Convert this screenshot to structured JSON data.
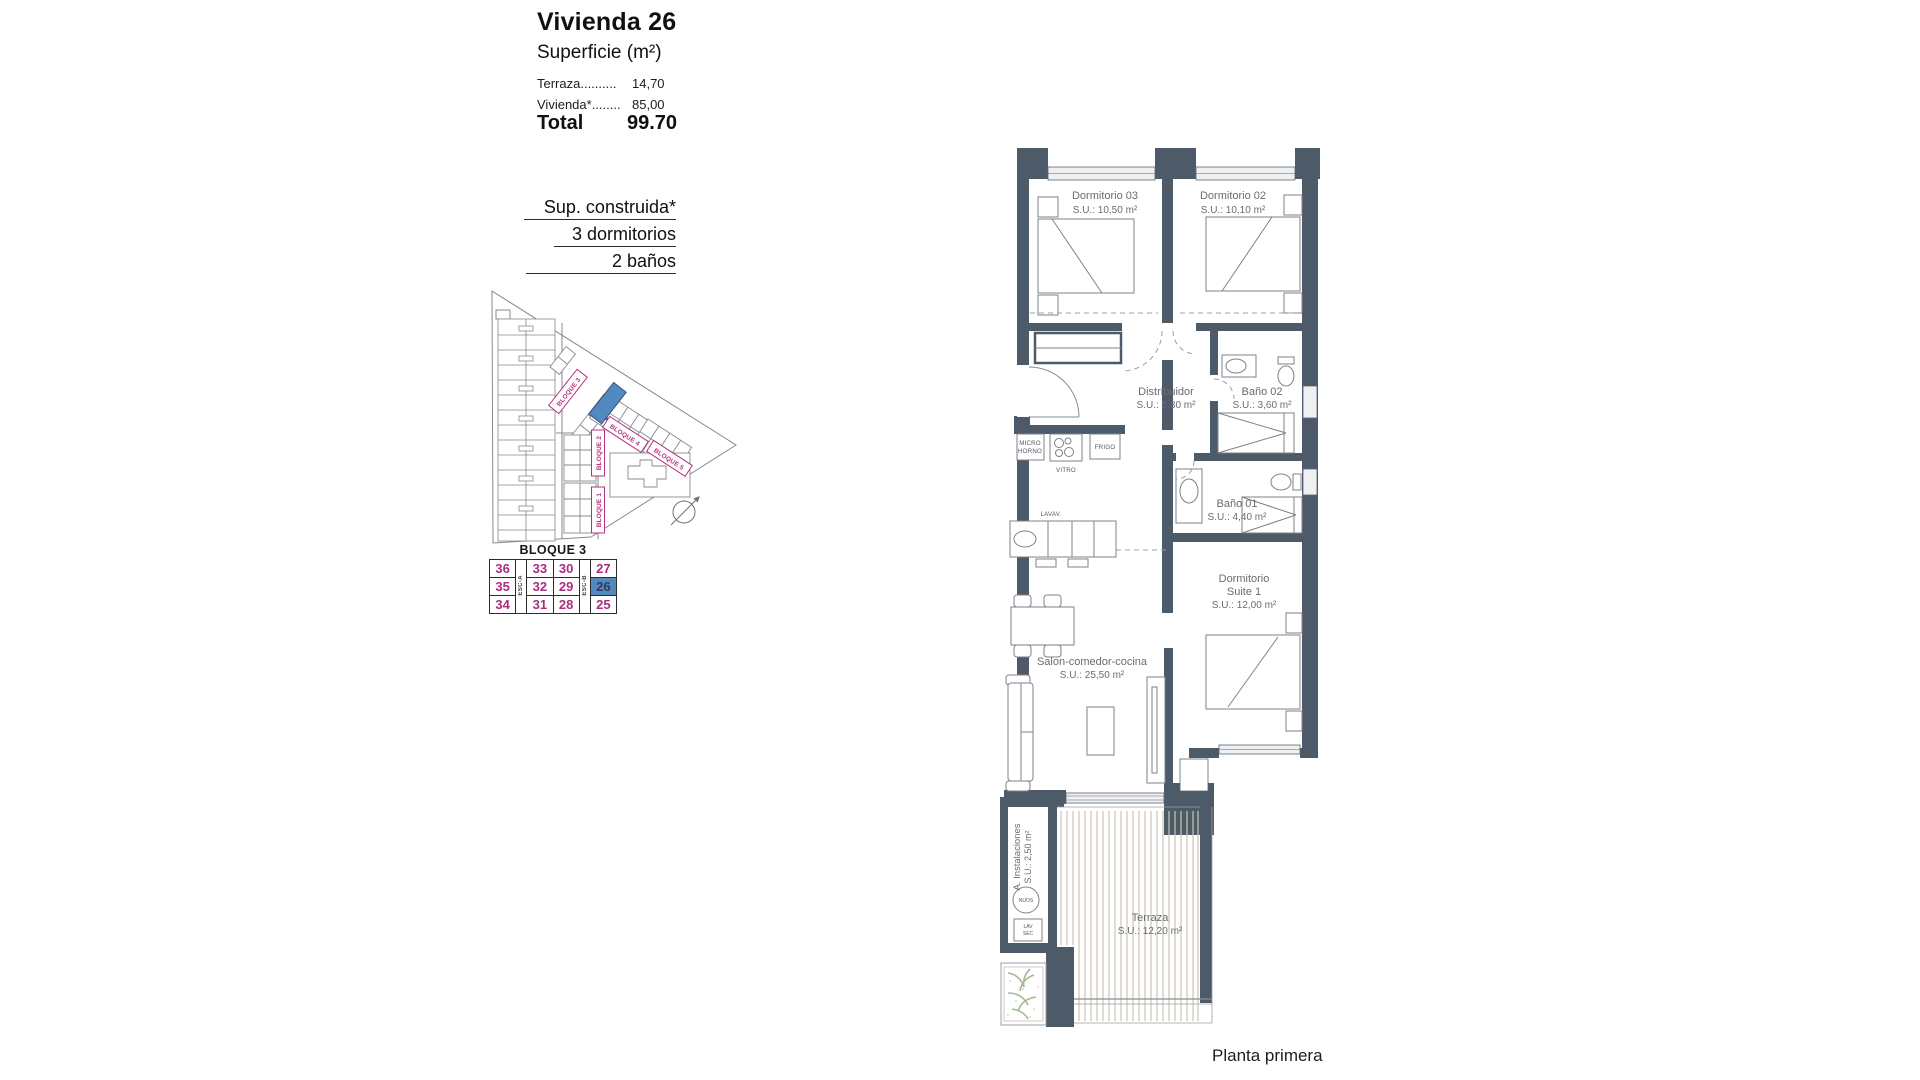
{
  "header": {
    "title": "Vivienda 26",
    "subtitle": "Superficie (m²)",
    "rows": [
      {
        "label": "Terraza..........",
        "value": "14,70"
      },
      {
        "label": "Vivienda*........",
        "value": "85,00"
      }
    ],
    "total_label": "Total",
    "total_value": "99.70"
  },
  "built_info": {
    "title": "Sup. construida*",
    "bedrooms": "3 dormitorios",
    "bathrooms": "2 baños"
  },
  "site_plan": {
    "block_labels": {
      "b1": "BLOQUE 1",
      "b2": "BLOQUE 2",
      "b3": "BLOQUE 3",
      "b4": "BLOQUE 4",
      "b5": "BLOQUE 5"
    },
    "highlight_color": "#5289bf"
  },
  "block_table": {
    "title": "BLOQUE 3",
    "stair_a": "ESC-A",
    "stair_b": "ESC-B",
    "rows": [
      [
        "36",
        "33",
        "30",
        "27"
      ],
      [
        "35",
        "32",
        "29",
        "26"
      ],
      [
        "34",
        "31",
        "28",
        "25"
      ]
    ],
    "highlighted_unit": "26",
    "number_color": "#aa2d82",
    "highlight_bg": "#5289bf"
  },
  "floor_plan": {
    "wall_color": "#4d5a68",
    "rooms": {
      "dorm03": {
        "name": "Dormitorio 03",
        "area": "S.U.: 10,50 m²"
      },
      "dorm02": {
        "name": "Dormitorio 02",
        "area": "S.U.: 10,10 m²"
      },
      "distribuidor": {
        "name": "Distribuidor",
        "area": "S.U.: 5,80 m²"
      },
      "bano02": {
        "name": "Baño 02",
        "area": "S.U.: 3,60 m²"
      },
      "bano01": {
        "name": "Baño 01",
        "area": "S.U.: 4,40 m²"
      },
      "suite": {
        "name_line1": "Dormitorio",
        "name_line2": "Suite 1",
        "area": "S.U.: 12,00 m²"
      },
      "salon": {
        "name": "Salon-comedor-cocina",
        "area": "S.U.: 25,50 m²"
      },
      "instalaciones": {
        "name": "A. Instalaciones",
        "area": "S.U.: 2,50 m²"
      },
      "terraza": {
        "name": "Terraza",
        "area": "S.U.: 12,20 m²"
      }
    },
    "appliances": {
      "micro_line1": "MICRO",
      "micro_line2": "HORNO",
      "vitro": "VITRO",
      "frigo": "FRIGO",
      "lavav": "LAVAV.",
      "nuos": "NUOS",
      "lav": "LAV",
      "sec": "SEC"
    }
  },
  "footer": {
    "caption": "Planta primera"
  }
}
